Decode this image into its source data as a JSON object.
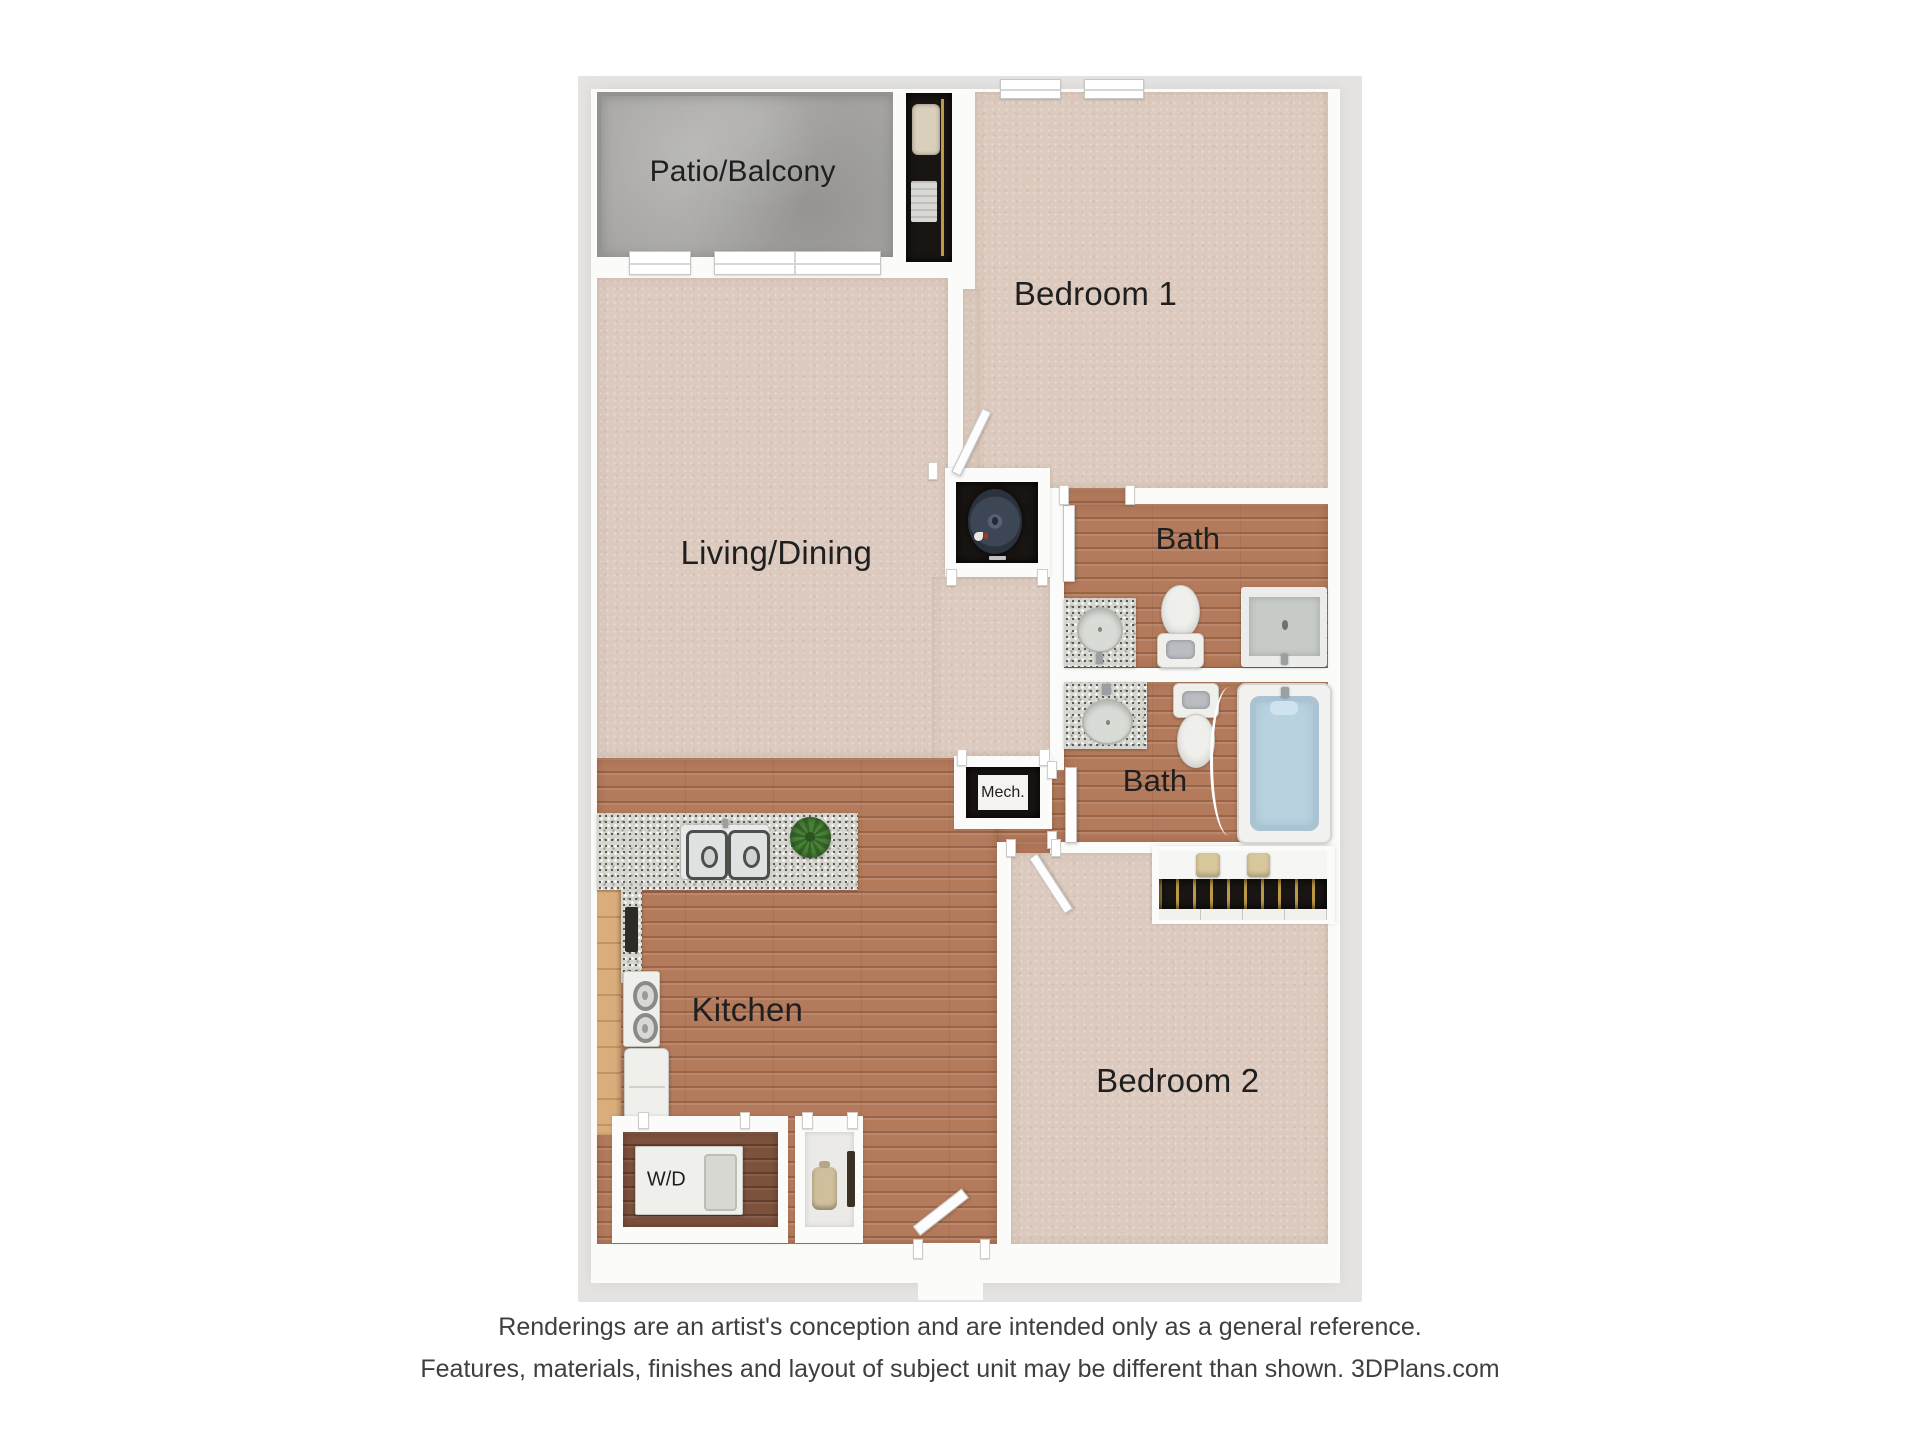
{
  "plan": {
    "labels": {
      "patio": "Patio/Balcony",
      "bedroom1": "Bedroom 1",
      "living": "Living/Dining",
      "bath1": "Bath",
      "bath2": "Bath",
      "mech": "Mech.",
      "kitchen": "Kitchen",
      "bedroom2": "Bedroom 2",
      "washer_dryer": "W/D"
    },
    "colors": {
      "exterior_band": "#e5e3e1",
      "wall": "#fbfbfa",
      "carpet": "#dccabe",
      "wood_floor": "#b47a5c",
      "wood_floor_dark": "#7d523d",
      "patio_concrete": "#a6a5a3",
      "closet_interior": "#191512",
      "granite_counter": "#d6d6d0",
      "tub_water": "#b9d2e0",
      "cabinet_wood": "#d9ad7c",
      "plant_green": "#4a8236",
      "label_text": "#1f1f1f",
      "footer_text": "#3f3f3f"
    }
  },
  "footer": {
    "line1": "Renderings are an artist's conception and are intended only as a general reference.",
    "line2": "Features, materials, finishes and layout of subject unit may be different than shown. 3DPlans.com"
  }
}
